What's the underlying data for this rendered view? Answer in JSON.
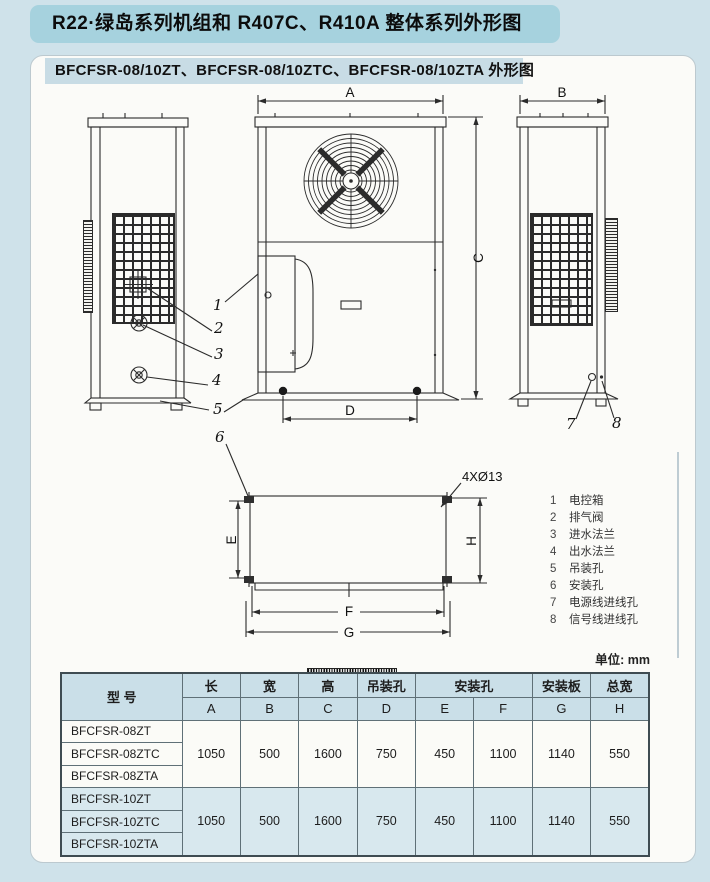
{
  "header": {
    "title": "R22·绿岛系列机组和 R407C、R410A 整体系列外形图",
    "subtitle": "BFCFSR-08/10ZT、BFCFSR-08/10ZTC、BFCFSR-08/10ZTA 外形图"
  },
  "colors": {
    "accent_blue": "#a6d2de",
    "table_blue": "#cadfe8",
    "row_blue": "#d8e8ee",
    "paper": "#fbfbf8"
  },
  "drawing": {
    "dims": {
      "A": "A",
      "B": "B",
      "C": "C",
      "D": "D",
      "E": "E",
      "F": "F",
      "G": "G",
      "H": "H"
    },
    "hole_note": "4XØ13",
    "callouts": [
      "1",
      "2",
      "3",
      "4",
      "5",
      "6",
      "7",
      "8"
    ],
    "legend": [
      {
        "no": "1",
        "label": "电控箱"
      },
      {
        "no": "2",
        "label": "排气阀"
      },
      {
        "no": "3",
        "label": "进水法兰"
      },
      {
        "no": "4",
        "label": "出水法兰"
      },
      {
        "no": "5",
        "label": "吊装孔"
      },
      {
        "no": "6",
        "label": "安装孔"
      },
      {
        "no": "7",
        "label": "电源线进线孔"
      },
      {
        "no": "8",
        "label": "信号线进线孔"
      }
    ]
  },
  "table": {
    "unit_note": "单位: mm",
    "header": {
      "model": "型  号",
      "length": "长",
      "width": "宽",
      "height": "高",
      "lifting_hole": "吊装孔",
      "mounting_hole": "安装孔",
      "mounting_plate": "安装板",
      "total_width": "总宽",
      "letters": [
        "A",
        "B",
        "C",
        "D",
        "E",
        "F",
        "G",
        "H"
      ]
    },
    "groups": [
      {
        "models": [
          "BFCFSR-08ZT",
          "BFCFSR-08ZTC",
          "BFCFSR-08ZTA"
        ],
        "values": [
          "1050",
          "500",
          "1600",
          "750",
          "450",
          "1100",
          "1140",
          "550"
        ]
      },
      {
        "models": [
          "BFCFSR-10ZT",
          "BFCFSR-10ZTC",
          "BFCFSR-10ZTA"
        ],
        "values": [
          "1050",
          "500",
          "1600",
          "750",
          "450",
          "1100",
          "1140",
          "550"
        ]
      }
    ]
  }
}
